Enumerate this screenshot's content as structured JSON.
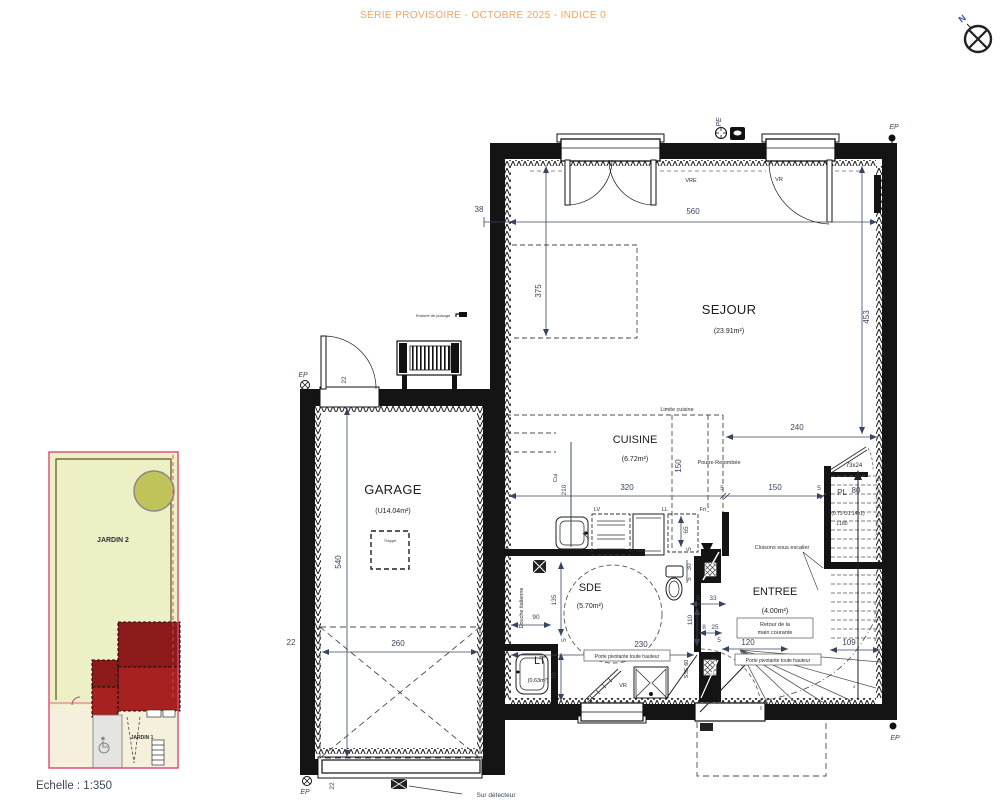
{
  "header": {
    "title": "SÉRIE PROVISOIRE - OCTOBRE 2025 - INDICE 0"
  },
  "compass": {
    "north": "N"
  },
  "site": {
    "jardin2": "JARDIN 2",
    "jardin1": "JARDIN 1",
    "scale": "Echelle : 1:350",
    "colors": {
      "garden": "#EDEFC4",
      "tree": "#BFC359",
      "building_dark": "#8D1A1A",
      "building_light": "#A82121",
      "border": "#D8456F",
      "path": "#F4F0DC",
      "drive": "#E4E4E2"
    }
  },
  "rooms": {
    "sejour": {
      "name": "SEJOUR",
      "area": "(23.91m²)"
    },
    "cuisine": {
      "name": "CUISINE",
      "area": "(6.72m²)"
    },
    "garage": {
      "name": "GARAGE",
      "area": "(U14.04m²)"
    },
    "sde": {
      "name": "SDE",
      "area": "(5.70m²)"
    },
    "entree": {
      "name": "ENTREE",
      "area": "(4.00m²)"
    },
    "lt": {
      "name": "LT",
      "area": "(0.63m²)"
    }
  },
  "labels": {
    "limite": "Limite cuisine",
    "poutre": "Poutre Retombée",
    "cloisons": "Cloisons sous escalier",
    "douche": "Douche italienne",
    "retour1": "Retour de la",
    "retour2": "main courante",
    "porte": "Porte pivotante toute hauteur",
    "trappe": "Trappe",
    "robinet": "Robinet de puisage",
    "detecteur": "Sur détecteur",
    "vre": "VRE",
    "vr": "VR",
    "cui": "Cui",
    "lv": "LV",
    "ll": "LL",
    "fri": "Fri",
    "sse": "SSE 60",
    "pl": "PL",
    "l180": "L180",
    "stair_dim": "73x24",
    "stair_door": "(0.73 U1.14h1)"
  },
  "markers": {
    "ep": "EP",
    "pe": "PE"
  },
  "dims": {
    "d560": "560",
    "d375": "375",
    "d453": "453",
    "d38": "38",
    "d240": "240",
    "d150": "150",
    "d320": "320",
    "d5": "5",
    "d210": "210",
    "d65": "65",
    "d90": "90",
    "d135": "135",
    "d70": "70",
    "d230": "230",
    "d110": "110",
    "d33": "33",
    "d8": "8",
    "d25": "25",
    "d120": "120",
    "d109": "109",
    "d30": "30",
    "d22": "22",
    "d260": "260",
    "d540": "540",
    "d80": "80"
  },
  "stairs": {
    "treads": [
      "1",
      "2",
      "3",
      "4",
      "5",
      "6",
      "7",
      "8",
      "9",
      "10",
      "11",
      "12",
      "13",
      "14",
      "15",
      "16"
    ]
  }
}
